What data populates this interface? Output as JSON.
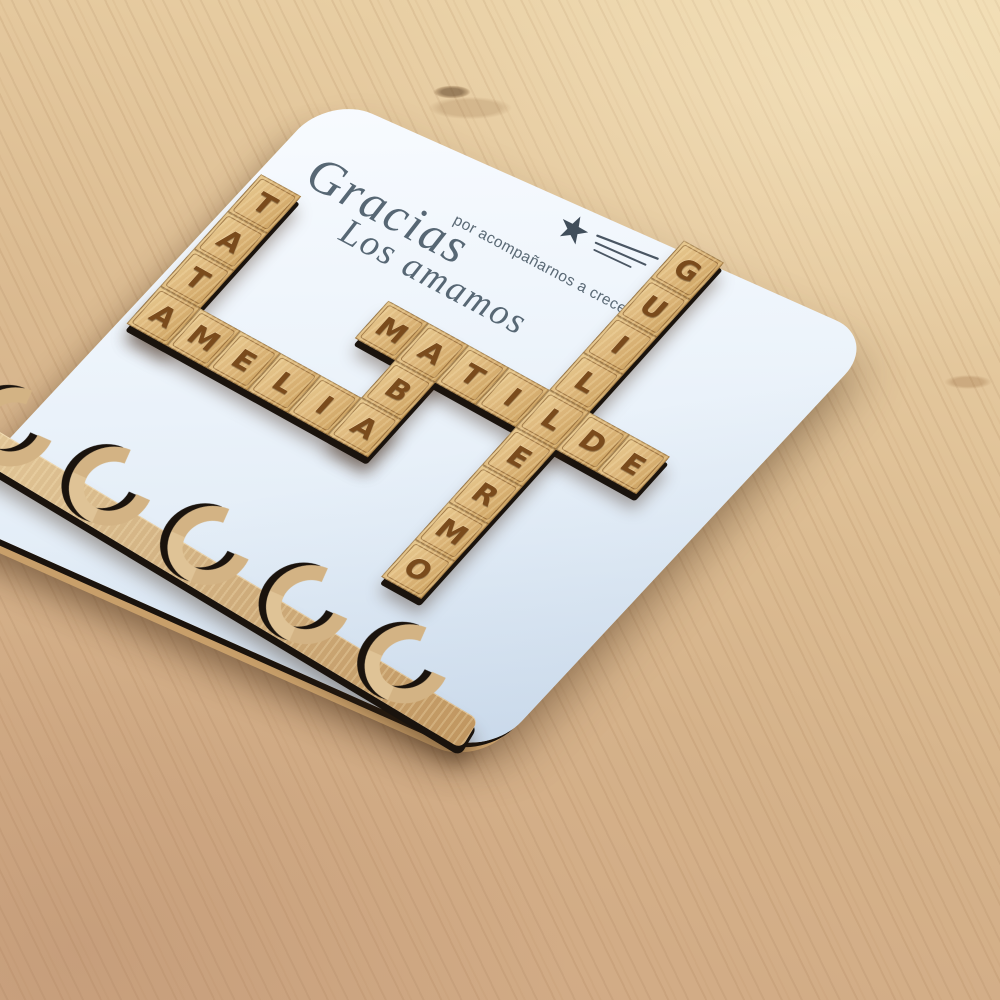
{
  "quote": {
    "script_word": "Gracias",
    "subtitle": "por acompañarnos a crecer,",
    "closing": "Los amamos"
  },
  "crossword": {
    "words": [
      {
        "text": "TATA",
        "direction": "down",
        "col": -4,
        "row": -1
      },
      {
        "text": "AMELIA",
        "direction": "across",
        "col": -4,
        "row": 2
      },
      {
        "text": "ABA",
        "direction": "down",
        "col": 1,
        "row": 0
      },
      {
        "text": "MATILDE",
        "direction": "across",
        "col": 0,
        "row": 0
      },
      {
        "text": "GUILLERMO",
        "direction": "down",
        "col": 4,
        "row": -4
      }
    ]
  },
  "key_rail": {
    "hooks": 5
  },
  "colors": {
    "board_surface": "#edf4fb",
    "tile_wood": "#ddb77c",
    "tile_letter": "#7a4b1c",
    "rail_wood": "#d3b384",
    "wood_edge_dark": "#1a130d",
    "base_wood_edge": "#c89f6a",
    "quote_ink": "#576774",
    "star": "#414e5b"
  }
}
